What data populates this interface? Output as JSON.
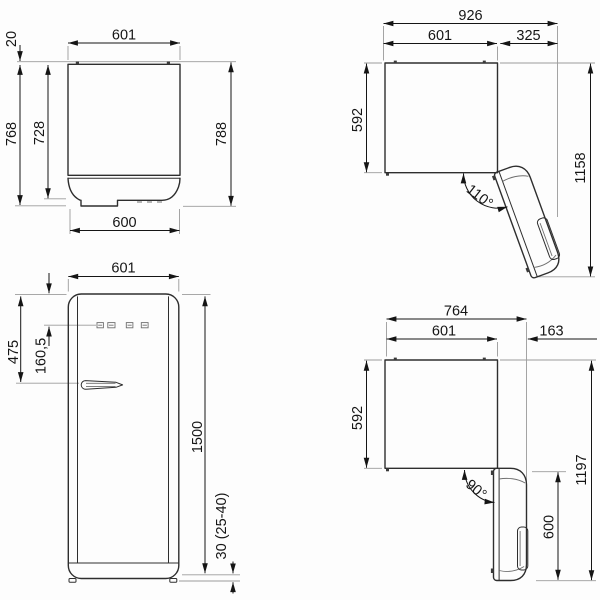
{
  "colors": {
    "outline": "#2e2e2e",
    "dimension": "#151515",
    "extension": "#9b9b9b",
    "detail": "#6f6f6f",
    "background": "#fdfdfd"
  },
  "views": {
    "back": {
      "dims": {
        "top_width": "601",
        "hinge_offset": "20",
        "height_cabinet": "768",
        "height_inner": "728",
        "height_total": "788",
        "bottom_width": "600"
      }
    },
    "top_open_110": {
      "dims": {
        "overall_width": "926",
        "cabinet_width": "601",
        "door_projection": "325",
        "depth": "592",
        "overall_depth": "1158",
        "angle": "110°"
      }
    },
    "front": {
      "dims": {
        "width": "601",
        "handle_height": "475",
        "panel_height": "160,5",
        "height": "1500",
        "feet_height": "30 (25-40)"
      }
    },
    "top_open_90": {
      "dims": {
        "overall_width": "764",
        "cabinet_width": "601",
        "door_projection": "163",
        "depth": "592",
        "overall_depth": "1197",
        "door_depth": "600",
        "angle": "90°"
      }
    }
  }
}
